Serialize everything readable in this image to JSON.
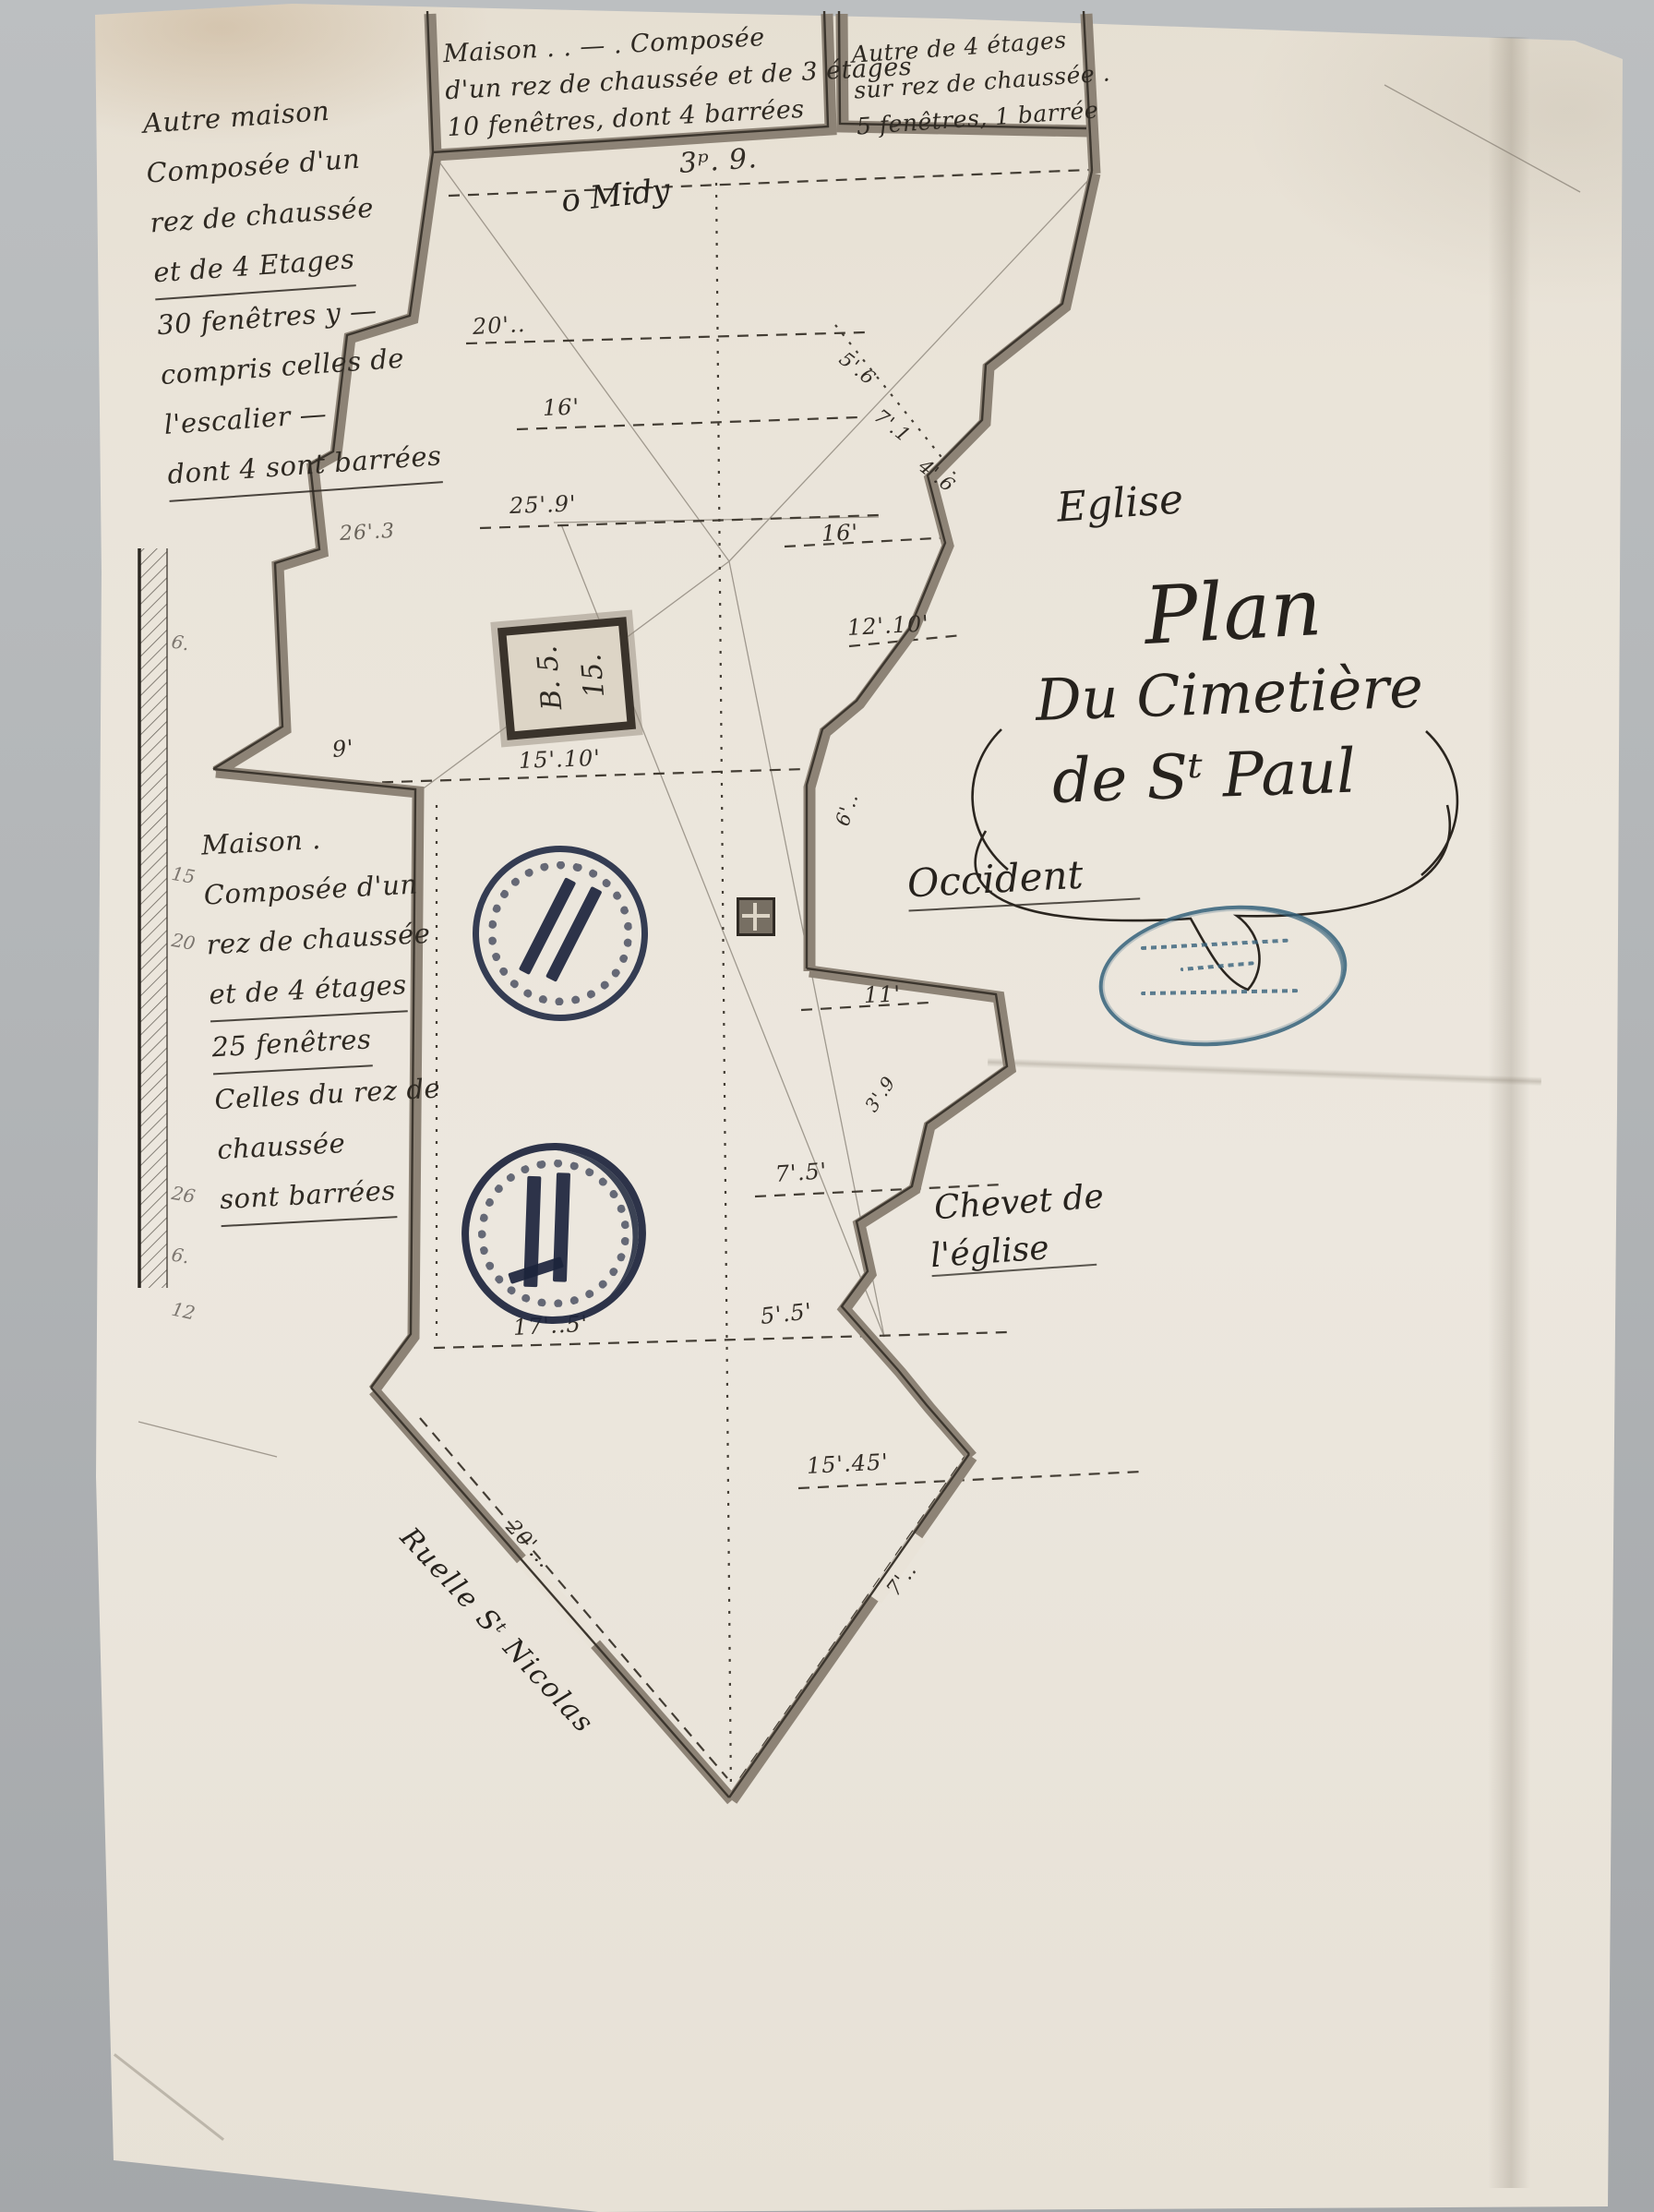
{
  "labels": {
    "midy": "o Midy",
    "eglise": "Eglise",
    "occident": "Occident",
    "title1": "Plan",
    "title2": "Du Cimetière",
    "title3": "de Sᵗ Paul",
    "chevet1": "Chevet de",
    "chevet2": "l'église",
    "ruelle": "Ruelle Sᵗ Nicolas"
  },
  "notes": {
    "top_left": [
      "Autre maison",
      "Composée d'un",
      "rez de chaussée",
      "et de 4 Etages",
      "30 fenêtres y —",
      "compris celles de",
      "l'escalier —",
      "dont 4 sont barrées"
    ],
    "top_center": [
      "Maison . . — . Composée",
      "d'un rez de chaussée et de 3 étages",
      "10 fenêtres, dont 4 barrées"
    ],
    "top_right": [
      "Autre de 4 étages",
      "sur rez de chaussée .",
      "5 fenêtres, 1 barrée"
    ],
    "mid_left": [
      "Maison .",
      "Composée d'un",
      "rez de chaussée",
      "et de 4 étages",
      "25 fenêtres",
      "Celles du rez de",
      "chaussée",
      "sont barrées"
    ]
  },
  "plot_square": {
    "a": "B. 5.",
    "b": "15."
  },
  "dims": [
    "3ᵖ. 9.",
    "20'..",
    "16'",
    "25'.9'",
    "26'.3",
    "16'",
    "12'.10'",
    "15'.10'",
    "9'",
    "11'",
    "7'.5'",
    "17'..5'",
    "5'.5'",
    "15'.45'",
    "5'.6",
    "7'.1",
    "4'.6",
    "20'...",
    "7'..",
    "6'..",
    "3'.9"
  ],
  "strip": [
    "6.",
    "15",
    "20",
    "26",
    "6.",
    "12"
  ],
  "colors": {
    "paper": "#e9e3d8",
    "background": "#b4b7b9",
    "ink": "#2f2a24",
    "wall": "#8d8376",
    "stamp_blue": "#3a647d",
    "stamp_navy": "#222943"
  }
}
